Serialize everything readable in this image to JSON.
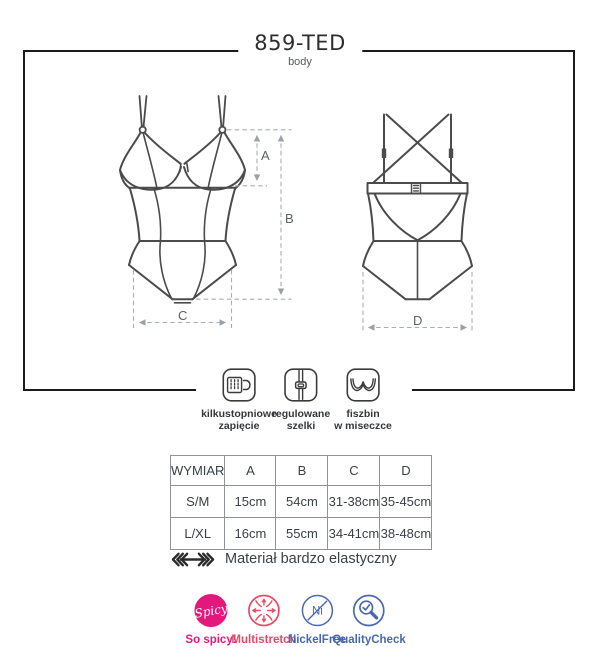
{
  "header": {
    "title": "859-TED",
    "subtitle": "body"
  },
  "dims": {
    "a": "A",
    "b": "B",
    "c": "C",
    "d": "D"
  },
  "features": [
    {
      "icon": "hook-closure-icon",
      "label_line1": "kilkustopniowe",
      "label_line2": "zapięcie"
    },
    {
      "icon": "adjustable-straps-icon",
      "label_line1": "regulowane",
      "label_line2": "szelki"
    },
    {
      "icon": "underwire-cup-icon",
      "label_line1": "fiszbin",
      "label_line2": "w miseczce"
    }
  ],
  "size_table": {
    "headers": [
      "WYMIAR",
      "A",
      "B",
      "C",
      "D"
    ],
    "rows": [
      {
        "cells": [
          "S/M",
          "15cm",
          "54cm",
          "31-38cm",
          "35-45cm"
        ]
      },
      {
        "cells": [
          "L/XL",
          "16cm",
          "55cm",
          "34-41cm",
          "38-48cm"
        ]
      }
    ]
  },
  "material_note": "Materiał bardzo elastyczny",
  "badges": [
    {
      "icon": "spicy-badge-icon",
      "circle_text": "Spicy",
      "label": "So spicy!",
      "color": "#e2187d"
    },
    {
      "icon": "multistretch-icon",
      "circle_text": "",
      "label": "Multistretch",
      "color": "#e84a66"
    },
    {
      "icon": "nickel-free-icon",
      "circle_text": "Ni",
      "label": "NickelFree",
      "color": "#4a68b0"
    },
    {
      "icon": "quality-check-icon",
      "circle_text": "",
      "label": "QualityCheck",
      "color": "#4a68b0"
    }
  ],
  "colors": {
    "frame_border": "#1c1c1c",
    "line_art": "#4b4b4b",
    "dashed": "#a9adb2",
    "text_dark": "#3a4045",
    "table_border": "#8f9296"
  }
}
